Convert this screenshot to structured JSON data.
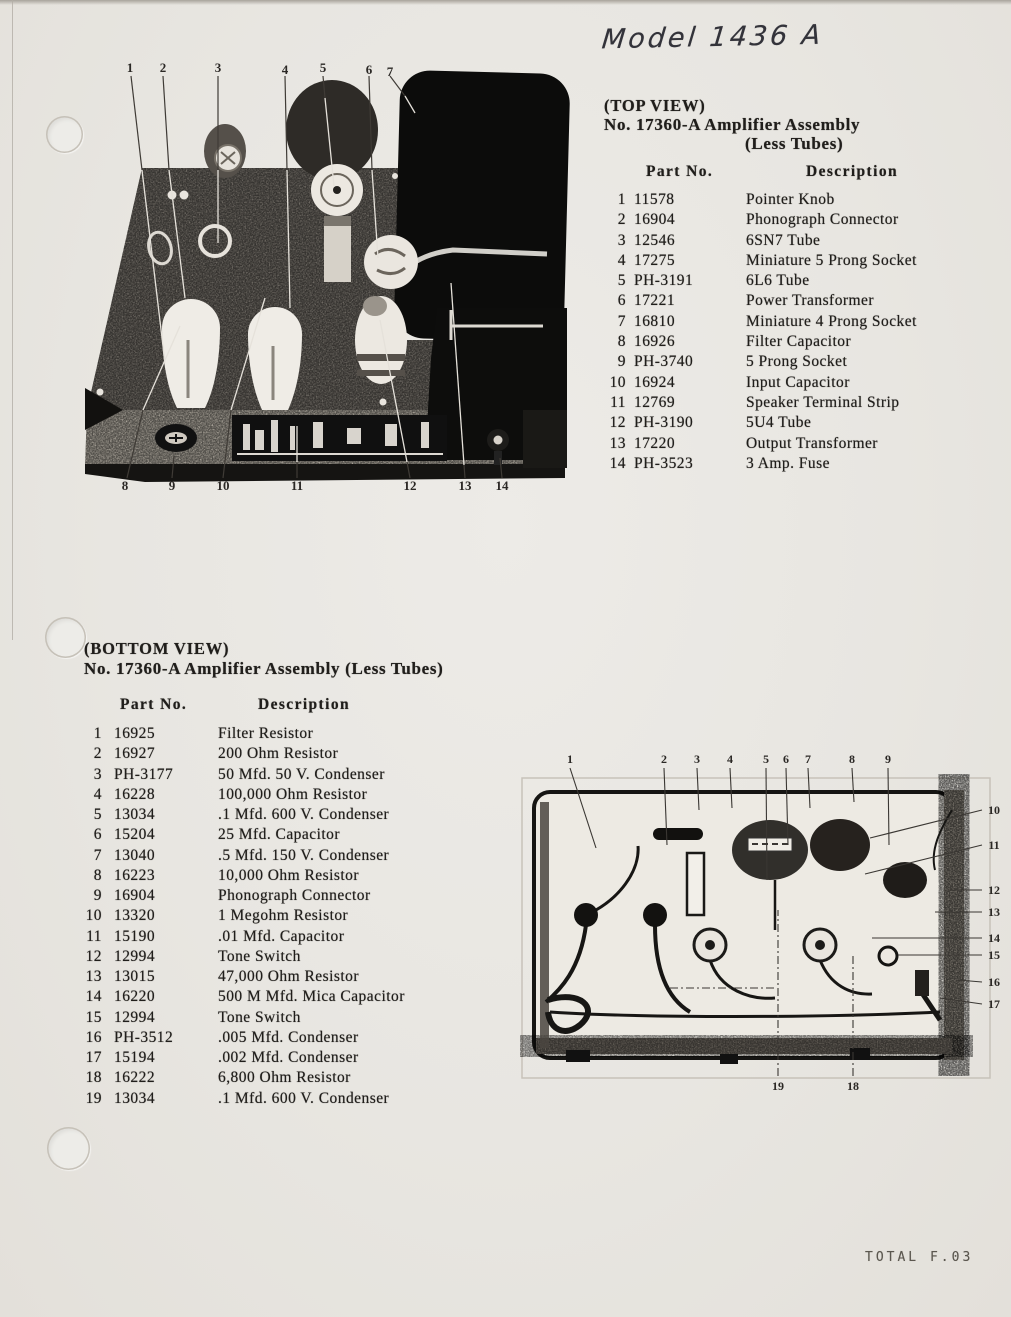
{
  "page": {
    "model_title": "Model 1436 A",
    "fax_footer": "TOTAL F.03"
  },
  "top_view": {
    "view_label": "(TOP VIEW)",
    "title": "No. 17360-A Amplifier Assembly",
    "subtitle": "(Less Tubes)",
    "col_part": "Part No.",
    "col_desc": "Description",
    "parts": [
      {
        "num": "1",
        "part": "11578",
        "desc": "Pointer Knob"
      },
      {
        "num": "2",
        "part": "16904",
        "desc": "Phonograph Connector"
      },
      {
        "num": "3",
        "part": "12546",
        "desc": "6SN7 Tube"
      },
      {
        "num": "4",
        "part": "17275",
        "desc": "Miniature 5 Prong Socket"
      },
      {
        "num": "5",
        "part": "PH-3191",
        "desc": "6L6 Tube"
      },
      {
        "num": "6",
        "part": "17221",
        "desc": "Power Transformer"
      },
      {
        "num": "7",
        "part": "16810",
        "desc": "Miniature 4 Prong Socket"
      },
      {
        "num": "8",
        "part": "16926",
        "desc": "Filter Capacitor"
      },
      {
        "num": "9",
        "part": "PH-3740",
        "desc": "5 Prong Socket"
      },
      {
        "num": "10",
        "part": "16924",
        "desc": "Input Capacitor"
      },
      {
        "num": "11",
        "part": "12769",
        "desc": "Speaker Terminal Strip"
      },
      {
        "num": "12",
        "part": "PH-3190",
        "desc": "5U4 Tube"
      },
      {
        "num": "13",
        "part": "17220",
        "desc": "Output Transformer"
      },
      {
        "num": "14",
        "part": "PH-3523",
        "desc": "3 Amp. Fuse"
      }
    ]
  },
  "top_photo": {
    "callouts_top": [
      "1",
      "2",
      "3",
      "4",
      "5",
      "6",
      "7"
    ],
    "callouts_bottom": [
      "8",
      "9",
      "10",
      "11",
      "12",
      "13",
      "14"
    ]
  },
  "bottom_view": {
    "view_label": "(BOTTOM VIEW)",
    "title": "No. 17360-A Amplifier Assembly (Less Tubes)",
    "col_part": "Part No.",
    "col_desc": "Description",
    "parts": [
      {
        "num": "1",
        "part": "16925",
        "desc": "Filter Resistor"
      },
      {
        "num": "2",
        "part": "16927",
        "desc": "200 Ohm Resistor"
      },
      {
        "num": "3",
        "part": "PH-3177",
        "desc": "50 Mfd. 50 V. Condenser"
      },
      {
        "num": "4",
        "part": "16228",
        "desc": "100,000 Ohm Resistor"
      },
      {
        "num": "5",
        "part": "13034",
        "desc": ".1 Mfd. 600 V. Condenser"
      },
      {
        "num": "6",
        "part": "15204",
        "desc": "25 Mfd. Capacitor"
      },
      {
        "num": "7",
        "part": "13040",
        "desc": ".5 Mfd. 150 V. Condenser"
      },
      {
        "num": "8",
        "part": "16223",
        "desc": "10,000 Ohm Resistor"
      },
      {
        "num": "9",
        "part": "16904",
        "desc": "Phonograph Connector"
      },
      {
        "num": "10",
        "part": "13320",
        "desc": "1 Megohm Resistor"
      },
      {
        "num": "11",
        "part": "15190",
        "desc": ".01 Mfd. Capacitor"
      },
      {
        "num": "12",
        "part": "12994",
        "desc": "Tone Switch"
      },
      {
        "num": "13",
        "part": "13015",
        "desc": "47,000 Ohm Resistor"
      },
      {
        "num": "14",
        "part": "16220",
        "desc": "500 M Mfd. Mica Capacitor"
      },
      {
        "num": "15",
        "part": "12994",
        "desc": "Tone Switch"
      },
      {
        "num": "16",
        "part": "PH-3512",
        "desc": ".005 Mfd. Condenser"
      },
      {
        "num": "17",
        "part": "15194",
        "desc": ".002 Mfd. Condenser"
      },
      {
        "num": "18",
        "part": "16222",
        "desc": "6,800 Ohm Resistor"
      },
      {
        "num": "19",
        "part": "13034",
        "desc": ".1 Mfd. 600 V. Condenser"
      }
    ]
  },
  "bottom_photo": {
    "callouts_top": [
      "1",
      "2",
      "3",
      "4",
      "5",
      "6",
      "7",
      "8",
      "9"
    ],
    "callouts_right": [
      "10",
      "11",
      "12",
      "13",
      "14",
      "15",
      "16",
      "17"
    ],
    "callouts_bottom": [
      "19",
      "18"
    ]
  }
}
